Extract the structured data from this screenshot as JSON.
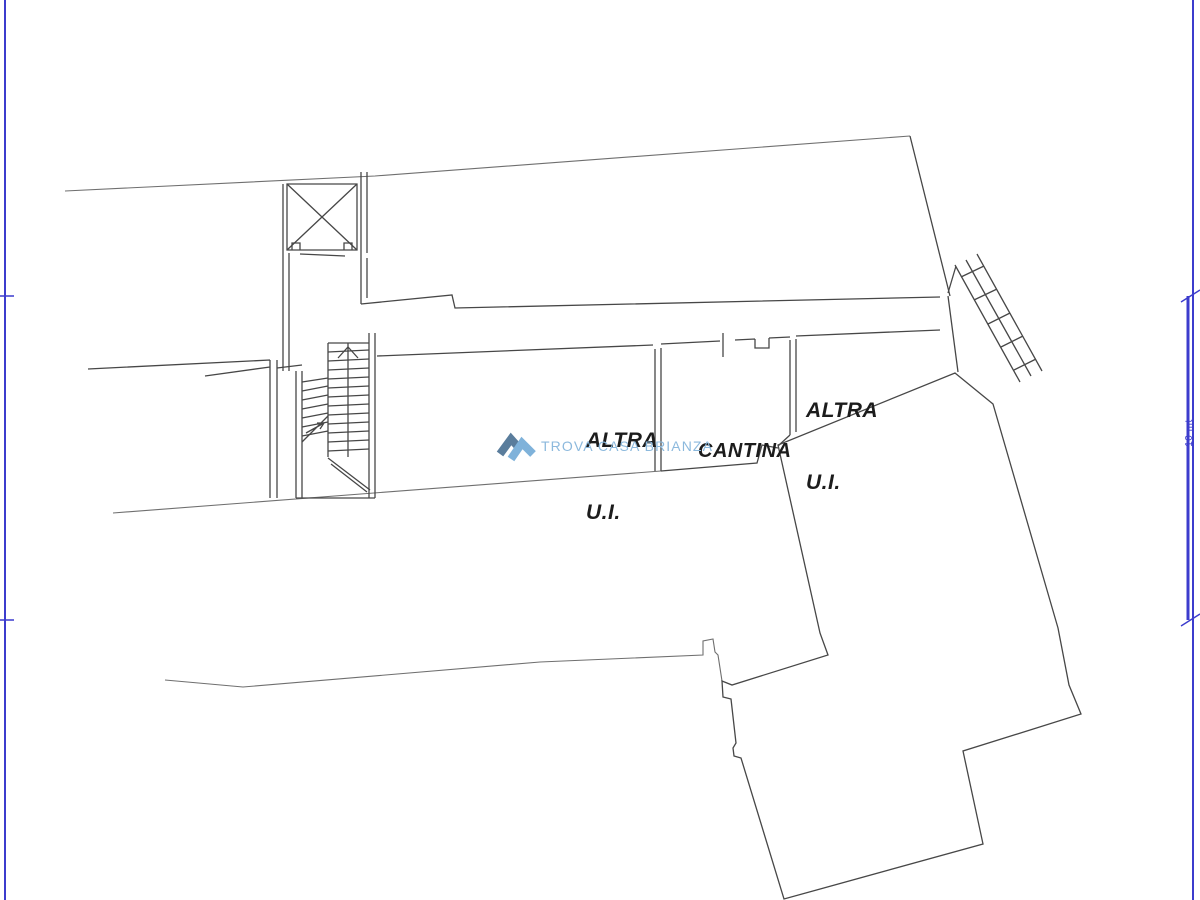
{
  "canvas": {
    "width": 1200,
    "height": 900,
    "background": "#ffffff"
  },
  "frame": {
    "color": "#3c3ccd",
    "scale_label": "10 mt"
  },
  "plan": {
    "line_color": "#474747",
    "site_line_color": "#6f6f6f",
    "rooms": [
      {
        "id": "altra-ui-left",
        "line1": "ALTRA",
        "line2": "U.I."
      },
      {
        "id": "cantina",
        "line1": "CANTINA",
        "line2": ""
      },
      {
        "id": "altra-ui-right",
        "line1": "ALTRA",
        "line2": "U.I."
      }
    ]
  },
  "watermark": {
    "text": "TROVA CASA BRIANZA",
    "text_color": "#8cb9dd",
    "logo_dark": "#5a7d9c",
    "logo_light": "#7fb2da"
  }
}
